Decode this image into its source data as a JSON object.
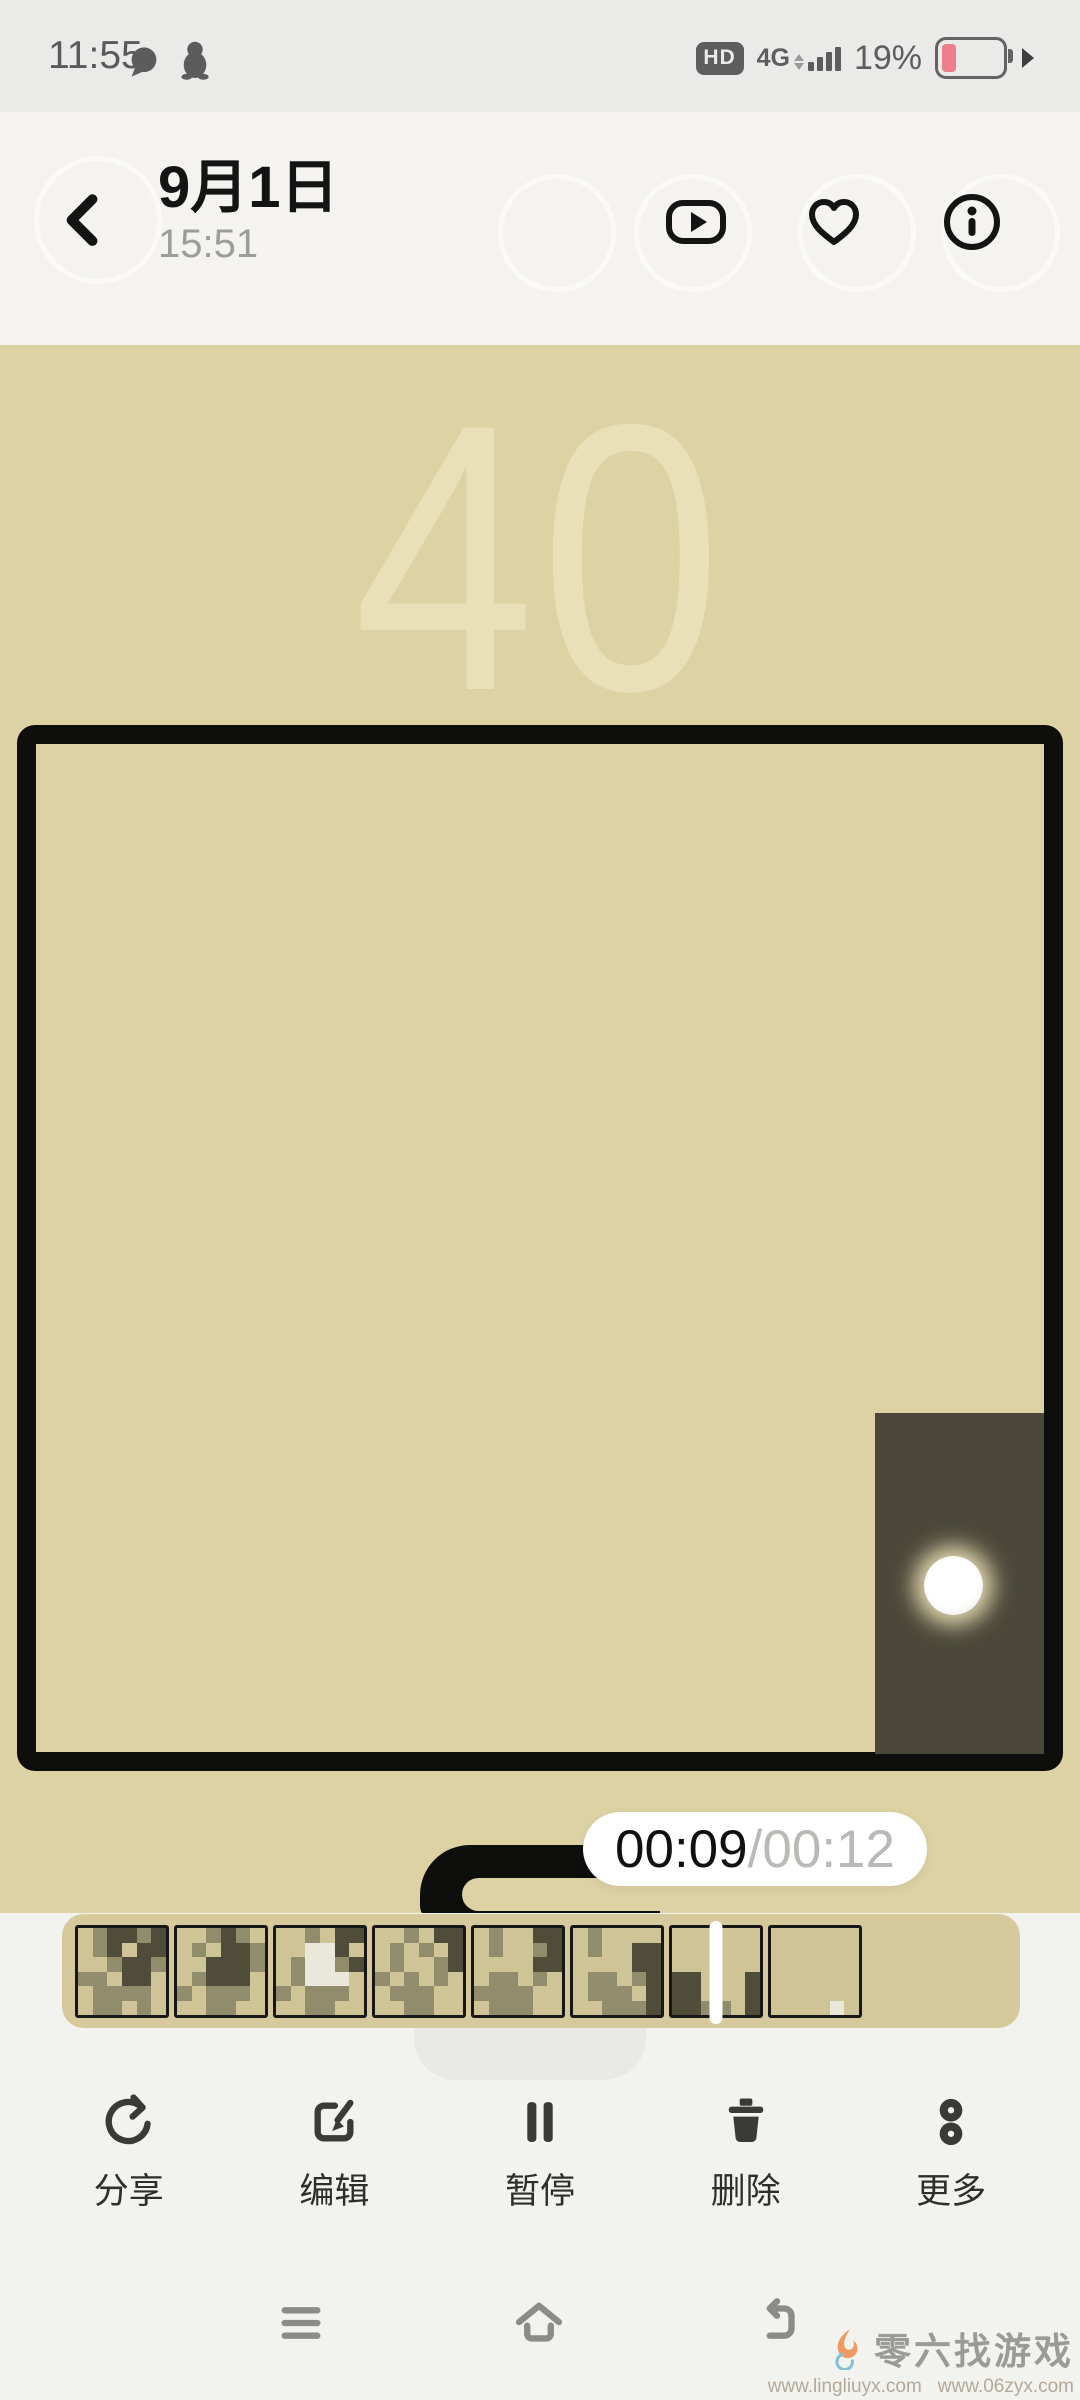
{
  "status_bar": {
    "time": "11:55",
    "hd_badge": "HD",
    "network": "4G",
    "battery_percent": "19%",
    "battery_level": 0.19,
    "battery_color": "#ee7e8b",
    "icons": [
      "message-icon",
      "qq-penguin-icon"
    ]
  },
  "header": {
    "title": "9月1日",
    "subtitle": "15:51",
    "action_icons": [
      "play-preview-icon",
      "favorite-icon",
      "info-icon"
    ]
  },
  "game": {
    "score": "40",
    "colors": {
      "background": "#ddd2a4",
      "wall": "#0e0e0d",
      "block": "#4b4839",
      "score_text": "#e9e0b8",
      "ball_glow": "#fff3c4"
    }
  },
  "player": {
    "current_time": "00:09",
    "separator": "/",
    "total_time": "00:12"
  },
  "filmstrip": {
    "palette": {
      "t": "#cfc496",
      "m": "#918c6c",
      "d": "#4f4c3a",
      "w": "#eae8db"
    },
    "playhead_thumb_index": 6,
    "thumbnails": [
      {
        "pattern": [
          "tmddmd",
          "tmdtdd",
          "ttmddm",
          "mmtddt",
          "tmmmmt",
          "tmmtmt"
        ]
      },
      {
        "pattern": [
          "ttmdmt",
          "tmtddm",
          "ttdddm",
          "tmdddt",
          "mtmmmt",
          "ttmmtt"
        ]
      },
      {
        "pattern": [
          "ttmtdd",
          "ttwwdt",
          "tmwwmd",
          "tmwwwt",
          "mtmmmt",
          "ttmmtt"
        ]
      },
      {
        "pattern": [
          "ttmtdd",
          "tmtmtd",
          "tmttmd",
          "mtmtmt",
          "tmmmtt",
          "ttmmtt"
        ]
      },
      {
        "pattern": [
          "tmttdd",
          "tmttmd",
          "ttttdd",
          "tmmtmt",
          "mmmmtt",
          "tmmmtt"
        ]
      },
      {
        "pattern": [
          "tmtttt",
          "tmttdd",
          "ttttdd",
          "tmmtmd",
          "tmmmtd",
          "ttmmmd"
        ]
      },
      {
        "pattern": [
          "tttttt",
          "tttttt",
          "tttttt",
          "ddtttd",
          "ddtttd",
          "ddmmtd"
        ]
      },
      {
        "pattern": [
          "tttttt",
          "tttttt",
          "tttttt",
          "tttttt",
          "tttttt",
          "ttttwt"
        ]
      }
    ]
  },
  "toolbar": {
    "items": [
      {
        "id": "share",
        "icon": "share-icon",
        "label": "分享"
      },
      {
        "id": "edit",
        "icon": "edit-icon",
        "label": "编辑"
      },
      {
        "id": "pause",
        "icon": "pause-icon",
        "label": "暂停"
      },
      {
        "id": "delete",
        "icon": "delete-icon",
        "label": "删除"
      },
      {
        "id": "more",
        "icon": "more-icon",
        "label": "更多"
      }
    ]
  },
  "nav_bar": {
    "items": [
      {
        "id": "menu",
        "icon": "menu-icon"
      },
      {
        "id": "home",
        "icon": "home-icon"
      },
      {
        "id": "back",
        "icon": "return-icon"
      }
    ]
  },
  "watermark": {
    "name": "零六找游戏",
    "urls": [
      "www.lingliuyx.com",
      "www.06zyx.com"
    ]
  }
}
